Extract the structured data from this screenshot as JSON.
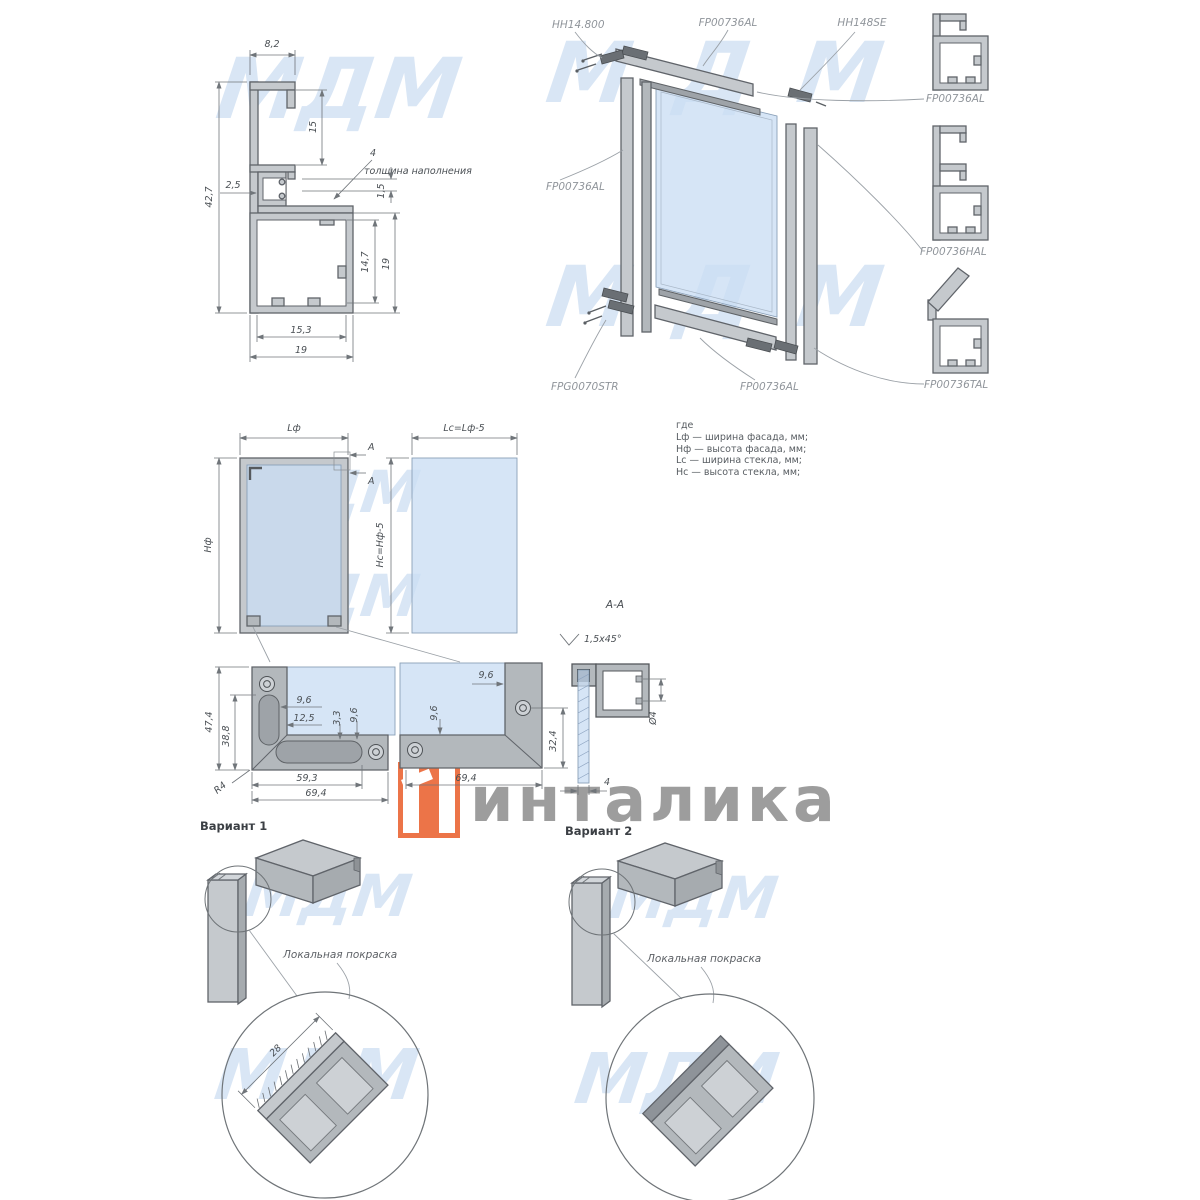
{
  "wm": {
    "text": "МДМ"
  },
  "logo": {
    "brand": "инталика"
  },
  "cs": {
    "w_top": "8,2",
    "h": "42,7",
    "wall": "2,5",
    "groove": "15",
    "fill": "4",
    "fill_note": "толщина наполнения",
    "lip": "1,5",
    "inner_h": "14,7",
    "box_h": "19",
    "inner_w": "15,3",
    "box_w": "19"
  },
  "asm": {
    "hinge": "HH14.800",
    "top": "FP00736AL",
    "seal": "HH148SE",
    "left": "FP00736AL",
    "gasket": "FPG0070STR",
    "bottom": "FP00736AL"
  },
  "panel": {
    "p1": "FP00736AL",
    "p2": "FP00736HAL",
    "p3": "FP00736TAL"
  },
  "fv": {
    "lf": "Lф",
    "hf": "Нф",
    "a": "A",
    "lc": "Lc=Lф-5",
    "hc": "Нс=Нф-5"
  },
  "legend": {
    "intro": "где",
    "l1": "Lф — ширина фасада, мм;",
    "l2": "Нф — высота фасада, мм;",
    "l3": "Lc — ширина стекла, мм;",
    "l4": "Нс — высота стекла, мм;"
  },
  "cl": {
    "d1": "47,4",
    "d2": "38,8",
    "d3": "9,6",
    "d4": "12,5",
    "d5": "3,3",
    "d6": "9,6",
    "d7": "59,3",
    "d8": "69,4",
    "r": "R4"
  },
  "cr": {
    "d1": "9,6",
    "d2": "9,6",
    "d3": "32,4",
    "d4": "69,4"
  },
  "aa": {
    "title": "A-A",
    "chamfer": "1,5x45°",
    "dia": "Ø4",
    "t": "4"
  },
  "v1": {
    "title": "Вариант 1",
    "note": "Локальная покраска",
    "d28": "28"
  },
  "v2": {
    "title": "Вариант 2",
    "note": "Локальная покраска"
  }
}
